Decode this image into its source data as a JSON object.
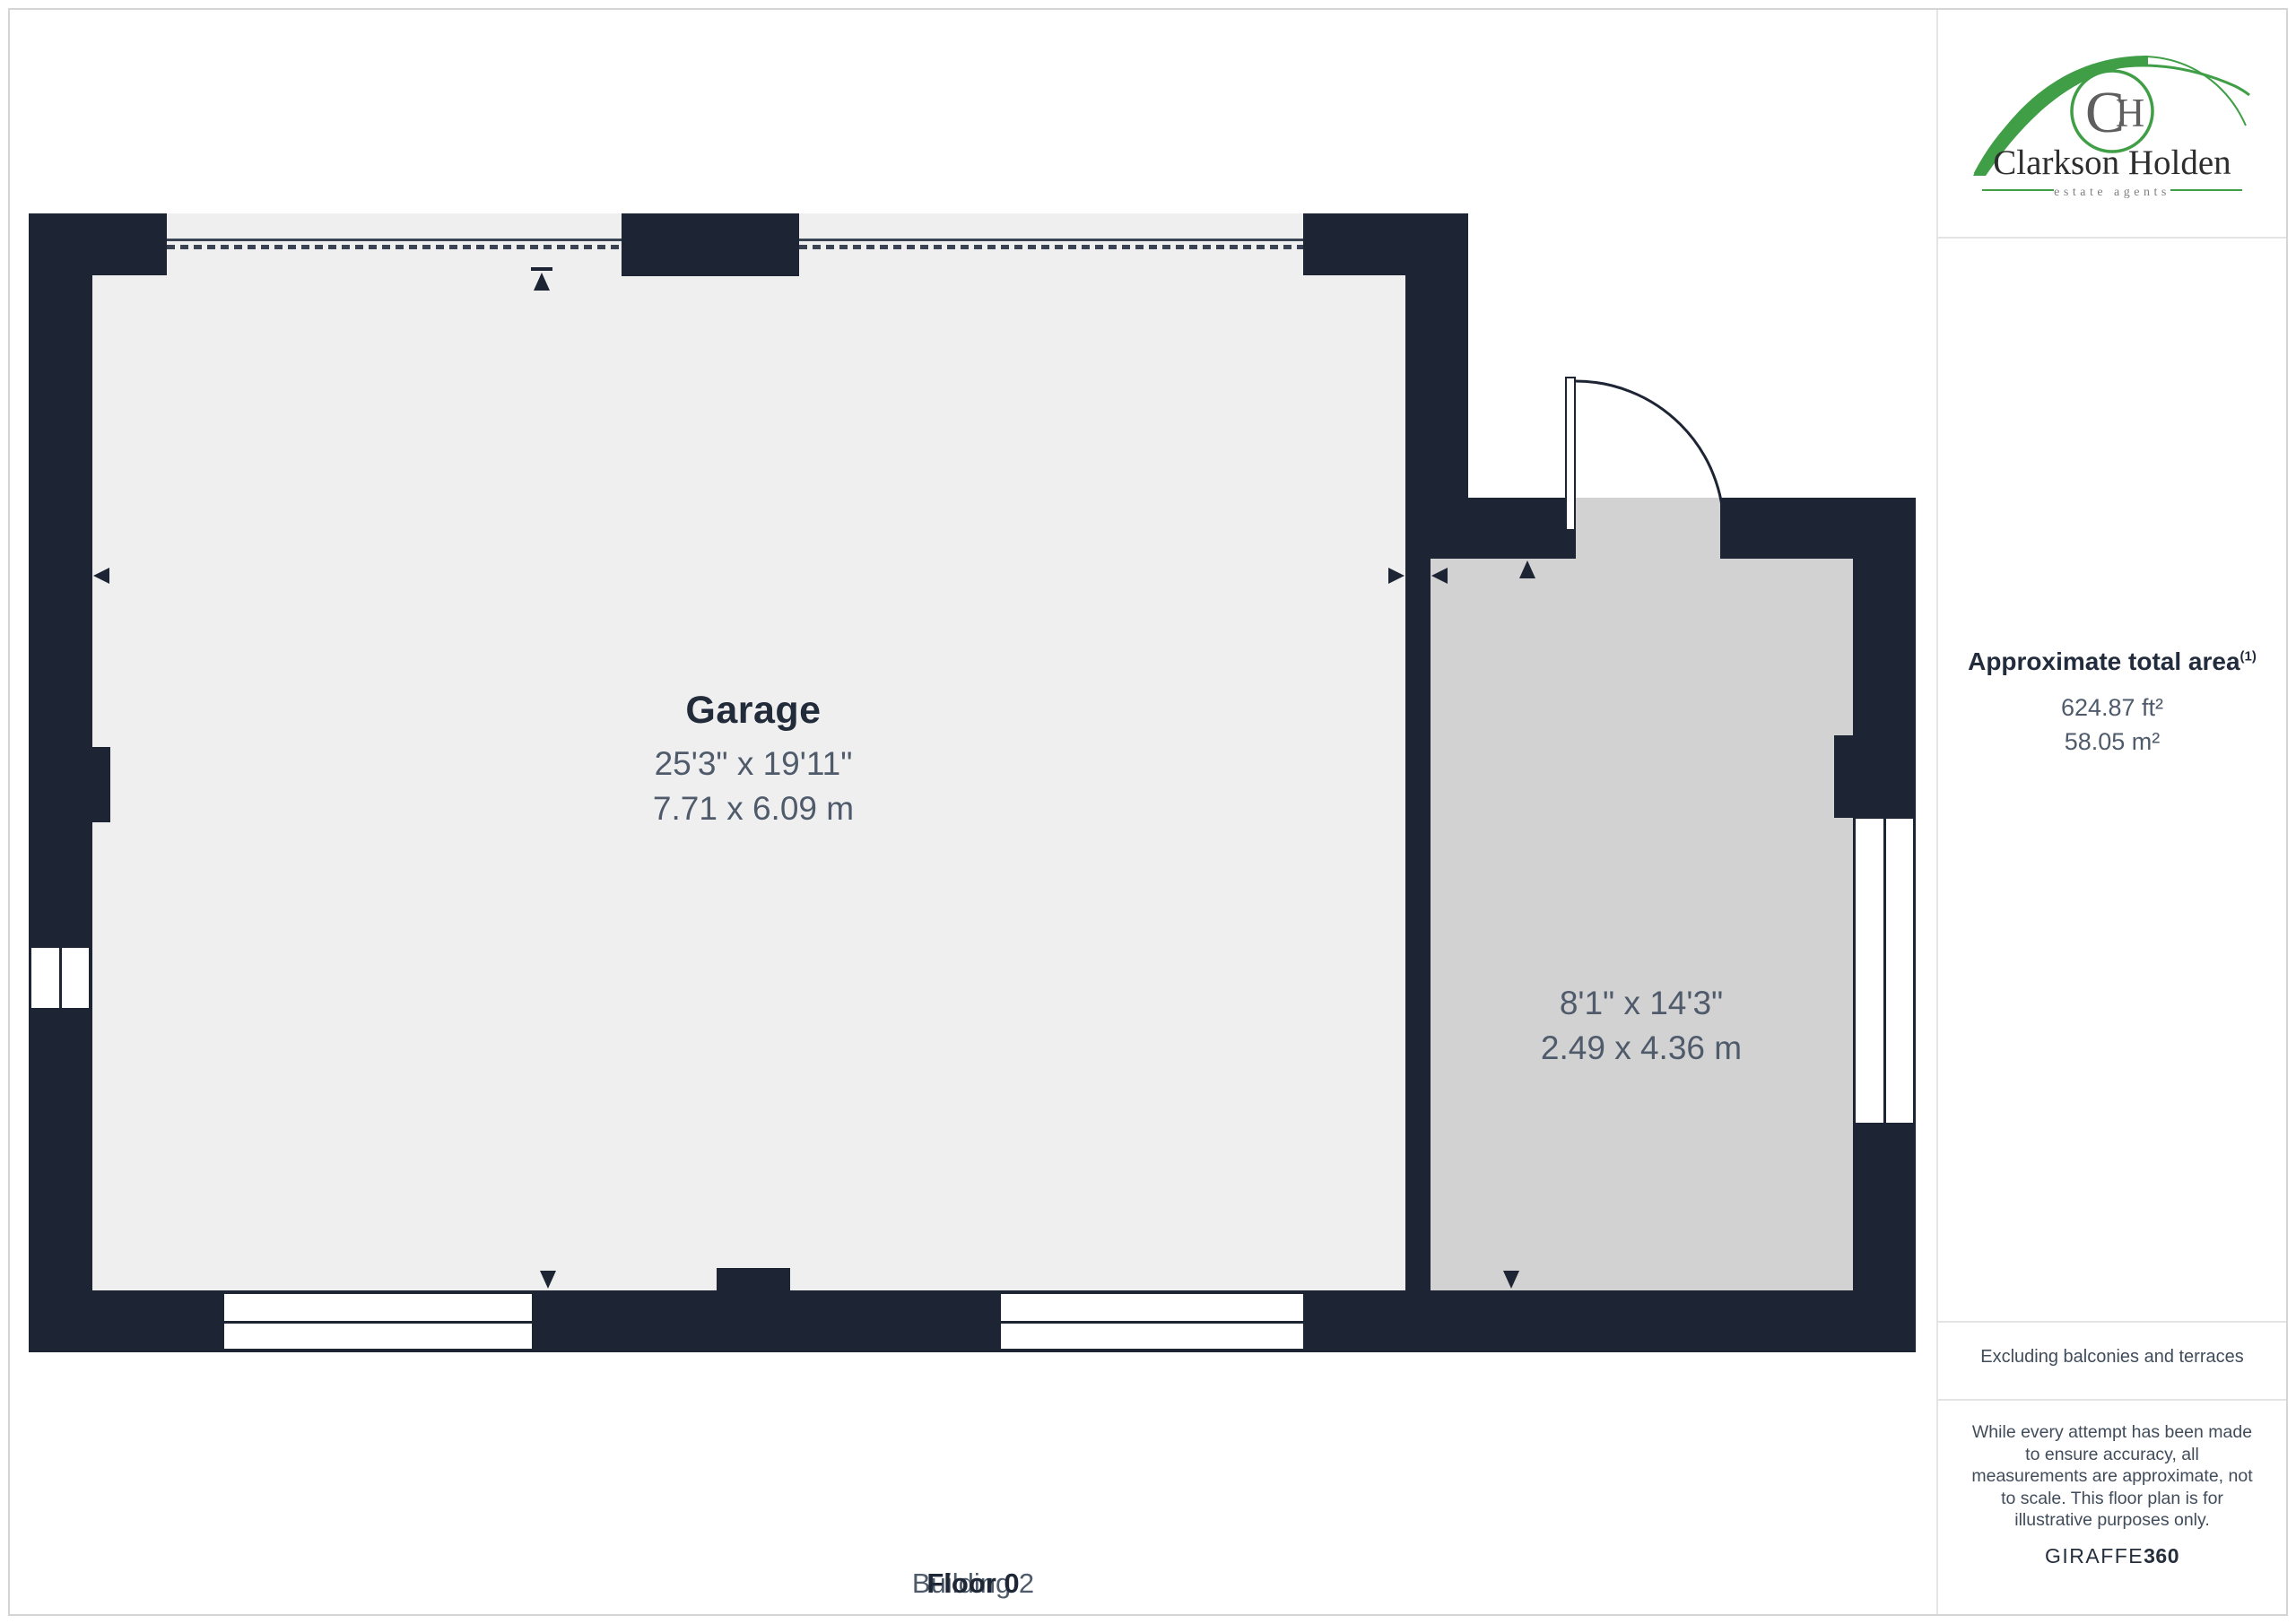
{
  "branding": {
    "monogram": "CH",
    "name": "Clarkson Holden",
    "tagline": "estate agents"
  },
  "sidebar": {
    "area": {
      "title": "Approximate total area",
      "title_superscript": "(1)",
      "imperial": "624.87 ft²",
      "metric": "58.05 m²"
    },
    "exclusion_note": "Excluding balconies and terraces",
    "disclaimer": "While every attempt has been made to ensure accuracy, all measurements are approximate, not to scale. This floor plan is for illustrative purposes only.",
    "provider_name": "GIRAFFE",
    "provider_suffix": "360"
  },
  "plan": {
    "rooms": [
      {
        "name": "Garage",
        "dims_imperial": "25'3\" x 19'11\"",
        "dims_metric": "7.71 x 6.09 m"
      },
      {
        "name": "",
        "dims_imperial": "8'1\" x 14'3\"",
        "dims_metric": "2.49 x 4.36 m"
      }
    ]
  },
  "footer": {
    "floor_label": "Floor 0",
    "building_label": "Building 2"
  },
  "colors": {
    "wall": "#1d2433",
    "garage_floor": "#efeff0",
    "room_floor": "#d2d2d3",
    "frame_border": "#d5d5d5",
    "divider": "#e4e4e6",
    "opening_line": "#394354",
    "accent_green": "#3f9e46",
    "logo_gray": "#5f5f5f",
    "text_muted": "#4f5b6b"
  }
}
